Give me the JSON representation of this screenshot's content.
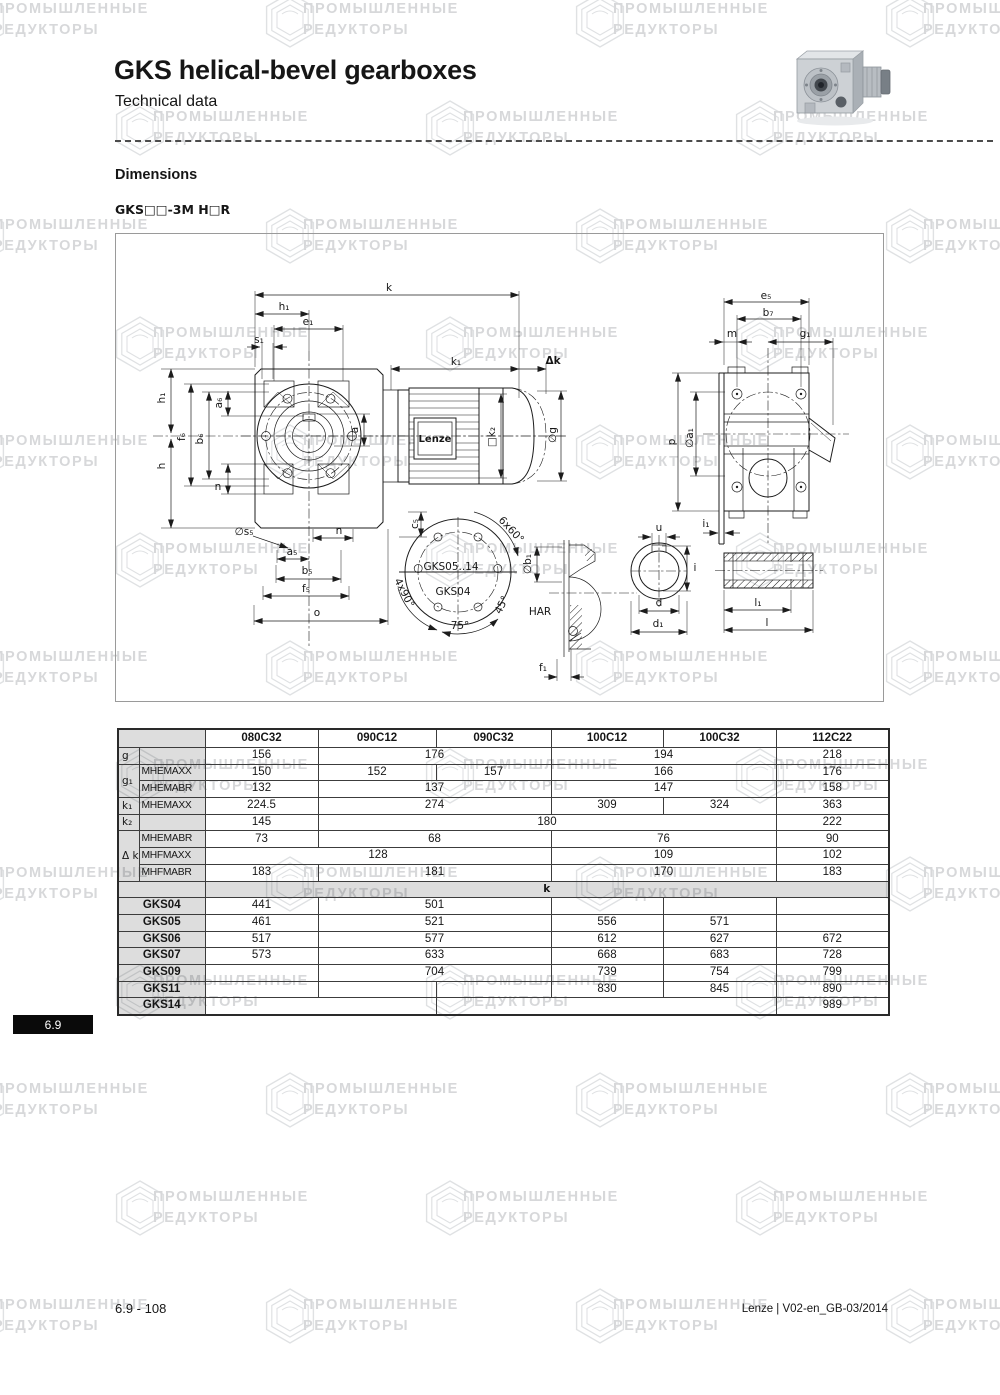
{
  "page": {
    "title": "GKS helical-bevel gearboxes",
    "subtitle": "Technical data",
    "section_heading": "Dimensions",
    "variant_label": "GKS□□-3M H□R",
    "tab_label": "6.9",
    "footer_left": "6.9 - 108",
    "footer_right": "Lenze | V02-en_GB-03/2014"
  },
  "watermark": {
    "line1": "ПРОМЫШЛЕННЫЕ",
    "line2": "РЕДУКТОРЫ",
    "text_color": "#d7d8da",
    "hex_color": "#dfe1e3"
  },
  "diagram": {
    "labels": [
      {
        "t": "k",
        "x": 388,
        "y": 287
      },
      {
        "t": "h₁",
        "x": 283,
        "y": 306
      },
      {
        "t": "e₁",
        "x": 307,
        "y": 321
      },
      {
        "t": "s₁",
        "x": 258,
        "y": 339
      },
      {
        "t": "k₁",
        "x": 455,
        "y": 361
      },
      {
        "t": "Δk",
        "x": 552,
        "y": 360,
        "b": 1
      },
      {
        "t": "h₁",
        "x": 161,
        "y": 397,
        "r": -90
      },
      {
        "t": "h",
        "x": 161,
        "y": 465,
        "r": -90
      },
      {
        "t": "f₆",
        "x": 181,
        "y": 436,
        "r": -90
      },
      {
        "t": "b₆",
        "x": 199,
        "y": 438,
        "r": -90
      },
      {
        "t": "a₆",
        "x": 218,
        "y": 402,
        "r": -90
      },
      {
        "t": "n",
        "x": 217,
        "y": 486
      },
      {
        "t": "a",
        "x": 354,
        "y": 429,
        "r": -90
      },
      {
        "t": "□k₂",
        "x": 491,
        "y": 436,
        "r": -90
      },
      {
        "t": "∅g",
        "x": 552,
        "y": 434,
        "r": -90
      },
      {
        "t": "∅s₅",
        "x": 243,
        "y": 531
      },
      {
        "t": "n",
        "x": 338,
        "y": 530
      },
      {
        "t": "a₅",
        "x": 291,
        "y": 551
      },
      {
        "t": "b₅",
        "x": 306,
        "y": 570
      },
      {
        "t": "f₅",
        "x": 305,
        "y": 588
      },
      {
        "t": "o",
        "x": 316,
        "y": 612
      },
      {
        "t": "c₅",
        "x": 414,
        "y": 523,
        "r": -90
      },
      {
        "t": "GKS05..14",
        "x": 450,
        "y": 566
      },
      {
        "t": "GKS04",
        "x": 452,
        "y": 591
      },
      {
        "t": "6x60°",
        "x": 510,
        "y": 529,
        "r": 47
      },
      {
        "t": "4x90°",
        "x": 403,
        "y": 592,
        "r": 63
      },
      {
        "t": "45°",
        "x": 501,
        "y": 604,
        "r": -63
      },
      {
        "t": "75°",
        "x": 459,
        "y": 625
      },
      {
        "t": "HAR",
        "x": 539,
        "y": 611
      },
      {
        "t": "∅b₁",
        "x": 527,
        "y": 563,
        "r": -90
      },
      {
        "t": "f₁",
        "x": 542,
        "y": 667
      },
      {
        "t": "u",
        "x": 658,
        "y": 527
      },
      {
        "t": "i",
        "x": 694,
        "y": 567
      },
      {
        "t": "d",
        "x": 658,
        "y": 602
      },
      {
        "t": "d₁",
        "x": 657,
        "y": 623
      },
      {
        "t": "l₁",
        "x": 757,
        "y": 602
      },
      {
        "t": "l",
        "x": 766,
        "y": 622
      },
      {
        "t": "i₁",
        "x": 705,
        "y": 523
      },
      {
        "t": "e₅",
        "x": 765,
        "y": 295
      },
      {
        "t": "b₇",
        "x": 767,
        "y": 312
      },
      {
        "t": "m",
        "x": 731,
        "y": 333
      },
      {
        "t": "g₁",
        "x": 804,
        "y": 333
      },
      {
        "t": "p",
        "x": 671,
        "y": 441,
        "r": -90
      },
      {
        "t": "∅a₁",
        "x": 689,
        "y": 437,
        "r": -90
      },
      {
        "t": "Lenze",
        "x": 434,
        "y": 438,
        "b": 1,
        "s": 10,
        "n": "motor-brand-label"
      }
    ]
  },
  "table": {
    "columns": [
      "080C32",
      "090C12",
      "090C32",
      "100C12",
      "100C32",
      "112C22"
    ],
    "param_rows": [
      {
        "sym": "g",
        "symspan": 1,
        "cond": "",
        "cells": [
          [
            "156",
            1
          ],
          [
            "176",
            2
          ],
          [
            "194",
            2
          ],
          [
            "218",
            1
          ]
        ]
      },
      {
        "sym": "g₁",
        "symspan": 2,
        "cond": "MHEMAXX",
        "cells": [
          [
            "150",
            1
          ],
          [
            "152",
            1
          ],
          [
            "157",
            1
          ],
          [
            "166",
            2
          ],
          [
            "176",
            1
          ]
        ]
      },
      {
        "cond": "MHEMABR",
        "cells": [
          [
            "132",
            1
          ],
          [
            "137",
            2
          ],
          [
            "147",
            2
          ],
          [
            "158",
            1
          ]
        ]
      },
      {
        "sym": "k₁",
        "symspan": 1,
        "cond": "MHEMAXX",
        "cells": [
          [
            "224.5",
            1
          ],
          [
            "274",
            2
          ],
          [
            "309",
            1
          ],
          [
            "324",
            1
          ],
          [
            "363",
            1
          ]
        ]
      },
      {
        "sym": "k₂",
        "symspan": 1,
        "cond": "",
        "cells": [
          [
            "145",
            1
          ],
          [
            "180",
            4
          ],
          [
            "222",
            1
          ]
        ]
      },
      {
        "sym": "Δ k",
        "symspan": 3,
        "cond": "MHEMABR",
        "cells": [
          [
            "73",
            1
          ],
          [
            "68",
            2
          ],
          [
            "76",
            2
          ],
          [
            "90",
            1
          ]
        ]
      },
      {
        "cond": "MHFMAXX",
        "cells": [
          [
            "128",
            3
          ],
          [
            "109",
            2
          ],
          [
            "102",
            1
          ]
        ]
      },
      {
        "cond": "MHFMABR",
        "cells": [
          [
            "183",
            1
          ],
          [
            "181",
            2
          ],
          [
            "170",
            2
          ],
          [
            "183",
            1
          ]
        ]
      }
    ],
    "section_label": "k",
    "gks_rows": [
      {
        "name": "GKS04",
        "cells": [
          [
            "441",
            1
          ],
          [
            "501",
            2
          ],
          [
            "",
            1
          ],
          [
            "",
            1
          ],
          [
            "",
            1
          ]
        ]
      },
      {
        "name": "GKS05",
        "cells": [
          [
            "461",
            1
          ],
          [
            "521",
            2
          ],
          [
            "556",
            1
          ],
          [
            "571",
            1
          ],
          [
            "",
            1
          ]
        ]
      },
      {
        "name": "GKS06",
        "cells": [
          [
            "517",
            1
          ],
          [
            "577",
            2
          ],
          [
            "612",
            1
          ],
          [
            "627",
            1
          ],
          [
            "672",
            1
          ]
        ]
      },
      {
        "name": "GKS07",
        "cells": [
          [
            "573",
            1
          ],
          [
            "633",
            2
          ],
          [
            "668",
            1
          ],
          [
            "683",
            1
          ],
          [
            "728",
            1
          ]
        ]
      },
      {
        "name": "GKS09",
        "cells": [
          [
            "",
            1
          ],
          [
            "704",
            2
          ],
          [
            "739",
            1
          ],
          [
            "754",
            1
          ],
          [
            "799",
            1
          ]
        ]
      },
      {
        "name": "GKS11",
        "cells": [
          [
            "",
            1
          ],
          [
            "",
            1
          ],
          [
            "",
            1
          ],
          [
            "830",
            1
          ],
          [
            "845",
            1
          ],
          [
            "890",
            1
          ]
        ]
      },
      {
        "name": "GKS14",
        "cells": [
          [
            "",
            2
          ],
          [
            "",
            3
          ],
          [
            "989",
            1
          ]
        ]
      }
    ]
  }
}
